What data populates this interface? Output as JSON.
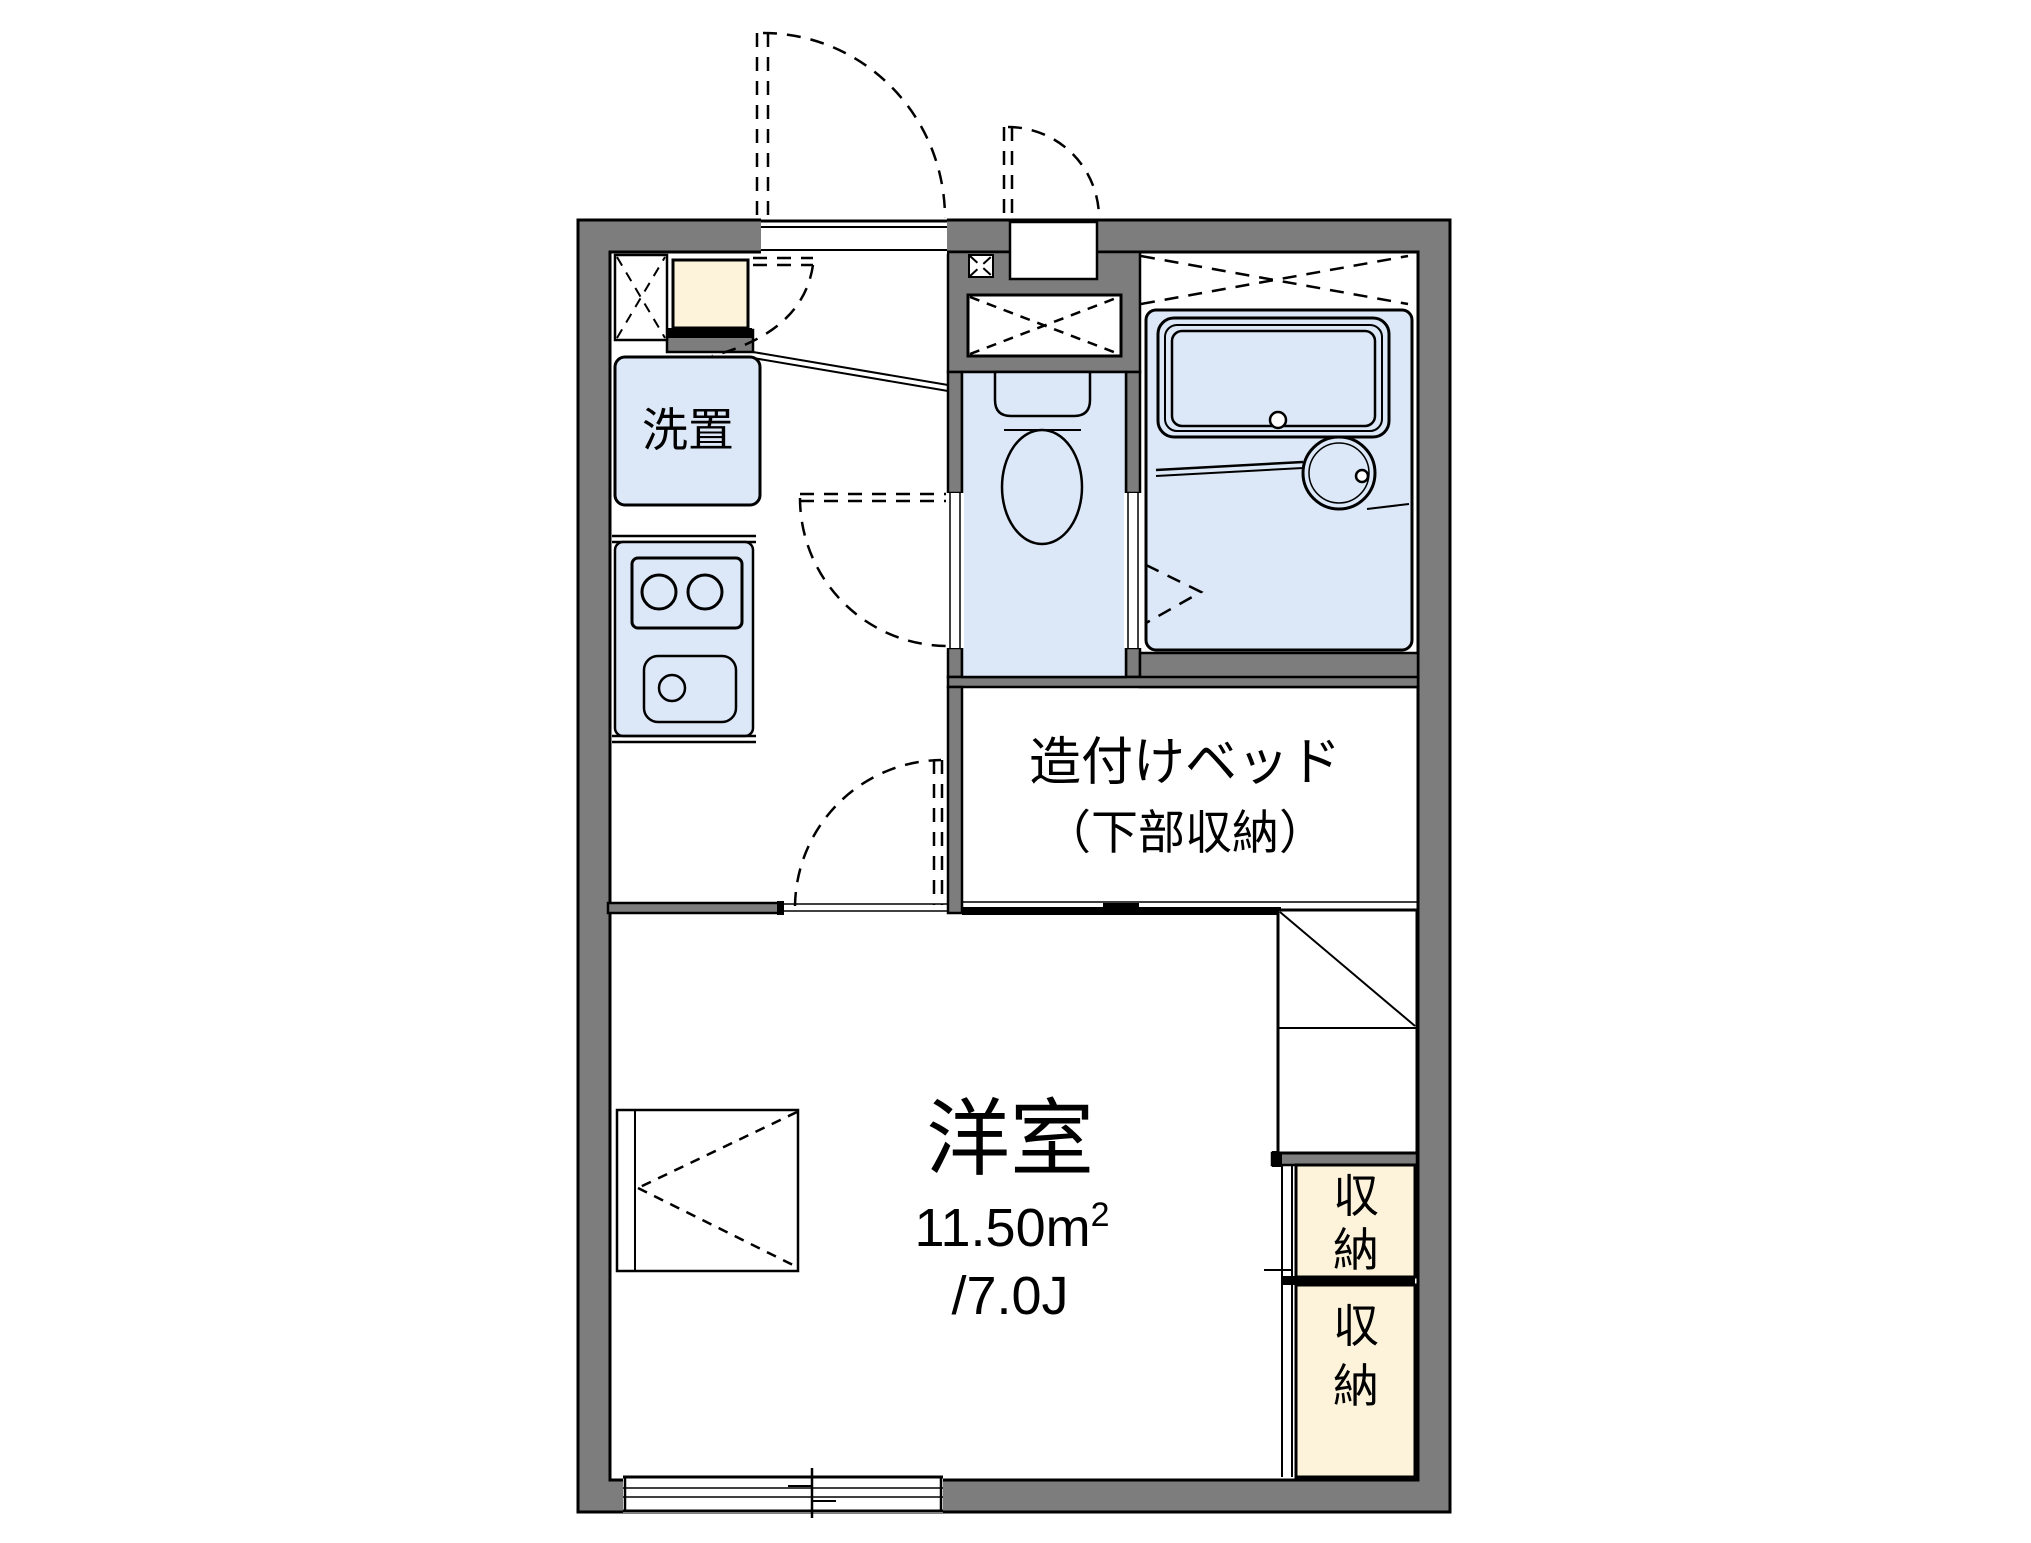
{
  "labels": {
    "washer_place": "洗置",
    "built_in_bed_line1": "造付けベッド",
    "built_in_bed_line2": "（下部収納）",
    "western_room": "洋室",
    "area_sqm": "11.50m",
    "area_sqm_sup": "2",
    "area_tatami": "/7.0J"
  },
  "storages": [
    {
      "top": "収",
      "bottom": "納"
    },
    {
      "top": "収",
      "bottom": "納"
    }
  ],
  "colors": {
    "wall_gray": "#7d7d7d",
    "fixture_blue": "#dce8f7",
    "storage_cream": "#fcf3da",
    "line_black": "#000000",
    "background": "#ffffff"
  }
}
